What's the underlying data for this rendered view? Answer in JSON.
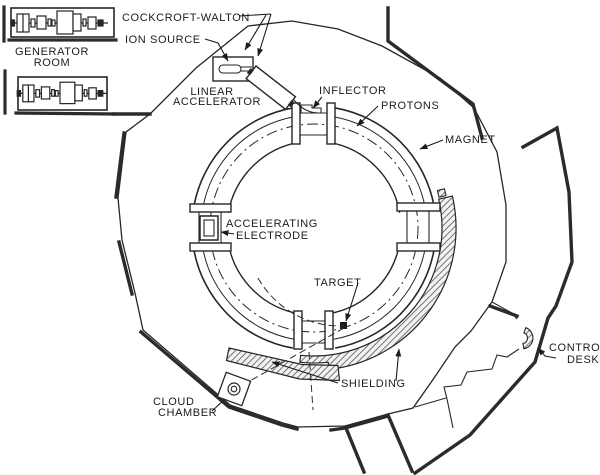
{
  "diagram": {
    "colors": {
      "ink": "#1f1f1f",
      "background": "#ffffff"
    },
    "labels": {
      "cockcroft_walton": "COCKCROFT-WALTON",
      "ion_source": "ION SOURCE",
      "generator_room_line1": "GENERATOR",
      "generator_room_line2": "ROOM",
      "linear_accelerator_line1": "LINEAR",
      "linear_accelerator_line2": "ACCELERATOR",
      "inflector": "INFLECTOR",
      "protons": "PROTONS",
      "magnet": "MAGNET",
      "accelerating_electrode_line1": "ACCELERATING",
      "accelerating_electrode_line2": "ELECTRODE",
      "target": "TARGET",
      "shielding": "SHIELDING",
      "cloud_chamber_line1": "CLOUD",
      "cloud_chamber_line2": "CHAMBER",
      "control_desk_line1": "CONTROL",
      "control_desk_line2": "DESK"
    }
  }
}
